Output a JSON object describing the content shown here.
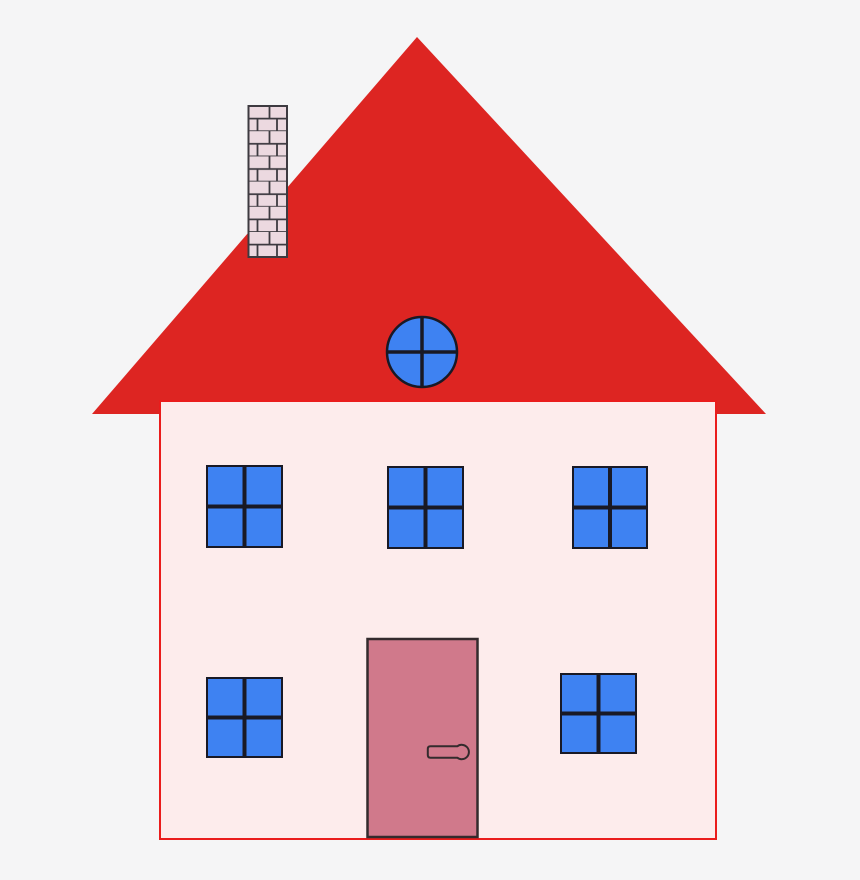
{
  "scene": {
    "subject": "clipart-house",
    "upper_window_count": 3,
    "lower_window_count": 2,
    "panes_per_window": 4,
    "has_chimney": true,
    "has_round_attic_window": true,
    "has_door": true
  },
  "colors": {
    "background": "#f5f5f6",
    "roof": "#dd2522",
    "wall": "#fdecec",
    "wall_border": "#ea1c1c",
    "window": "#3e82f2",
    "window_frame": "#191925",
    "door": "#d0798b",
    "door_frame": "#332b2d",
    "brick": "#ecd9e0",
    "brick_mortar": "#3d3a40"
  }
}
